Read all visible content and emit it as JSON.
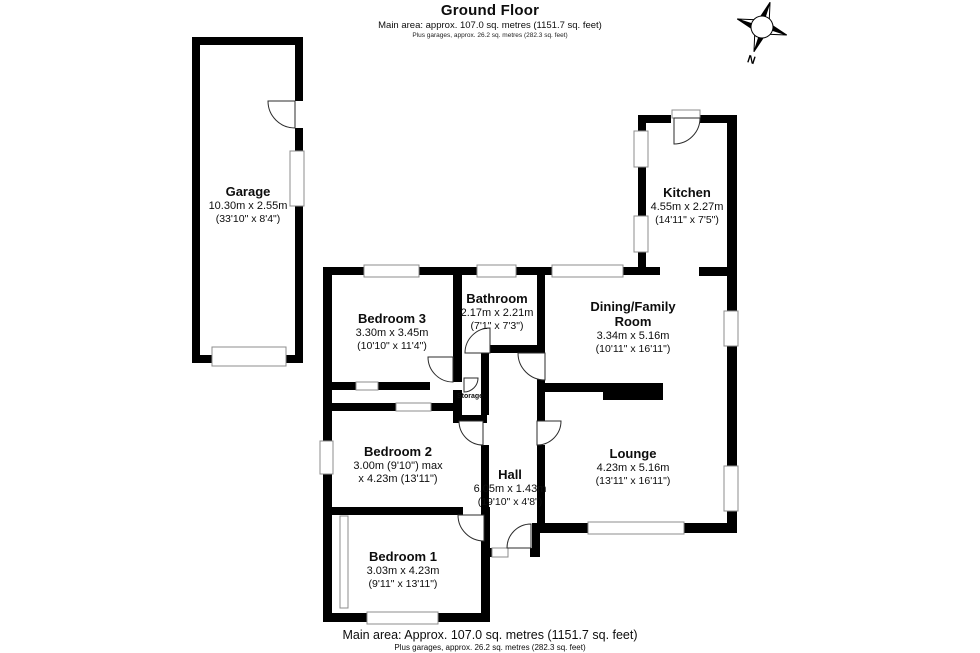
{
  "header": {
    "title": "Ground Floor",
    "subtitle": "Main area: approx. 107.0 sq. metres (1151.7 sq. feet)",
    "subtitle2": "Plus garages, approx. 26.2 sq. metres (282.3 sq. feet)"
  },
  "footer": {
    "line1": "Main area: Approx. 107.0 sq. metres (1151.7 sq. feet)",
    "line2": "Plus garages, approx. 26.2 sq. metres (282.3 sq. feet)"
  },
  "compass": {
    "label": "N"
  },
  "rooms": [
    {
      "id": "garage",
      "name": "Garage",
      "dims_metric": "10.30m x 2.55m",
      "dims_imperial": "(33'10\" x 8'4\")"
    },
    {
      "id": "kitchen",
      "name": "Kitchen",
      "dims_metric": "4.55m x 2.27m",
      "dims_imperial": "(14'11\" x 7'5\")"
    },
    {
      "id": "bedroom3",
      "name": "Bedroom 3",
      "dims_metric": "3.30m x 3.45m",
      "dims_imperial": "(10'10\" x 11'4\")"
    },
    {
      "id": "bathroom",
      "name": "Bathroom",
      "dims_metric": "2.17m x 2.21m",
      "dims_imperial": "(7'1\" x 7'3\")"
    },
    {
      "id": "dining",
      "name": "Dining/Family Room",
      "dims_metric": "3.34m x 5.16m",
      "dims_imperial": "(10'11\" x 16'11\")"
    },
    {
      "id": "bedroom2",
      "name": "Bedroom 2",
      "dims_metric": "3.00m (9'10\") max",
      "dims_imperial": "x 4.23m (13'11\")"
    },
    {
      "id": "hall",
      "name": "Hall",
      "dims_metric": "6.05m x 1.43m",
      "dims_imperial": "(19'10\" x 4'8\")"
    },
    {
      "id": "lounge",
      "name": "Lounge",
      "dims_metric": "4.23m x 5.16m",
      "dims_imperial": "(13'11\" x 16'11\")"
    },
    {
      "id": "bedroom1",
      "name": "Bedroom 1",
      "dims_metric": "3.03m x 4.23m",
      "dims_imperial": "(9'11\" x 13'11\")"
    },
    {
      "id": "storage",
      "name": "Storage"
    }
  ],
  "colors": {
    "wall": "#000000",
    "window_border": "#8c8c8c",
    "text": "#0d0d0d"
  }
}
